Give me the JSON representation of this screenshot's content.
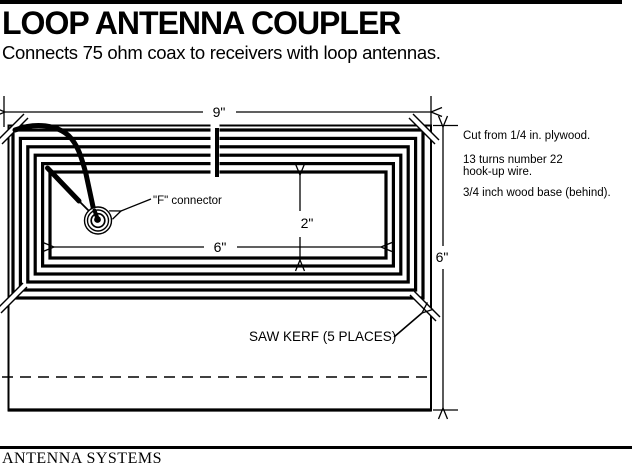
{
  "header": {
    "title": "LOOP ANTENNA COUPLER",
    "subtitle": "Connects 75 ohm coax to receivers with loop antennas."
  },
  "diagram": {
    "dimensions": {
      "overall_width": "9\"",
      "overall_height": "6\"",
      "inner_height": "2\"",
      "inner_width": "6\""
    },
    "labels": {
      "connector": "\"F\" connector",
      "saw_kerf": "SAW KERF (5 PLACES)"
    },
    "notes": {
      "line1": "Cut from 1/4 in. plywood.",
      "line2": "13 turns number 22",
      "line3": "hook-up wire.",
      "line4": "3/4 inch wood base (behind)."
    }
  },
  "footer": {
    "brand": "ANTENNA SYSTEMS"
  },
  "colors": {
    "ink": "#000000",
    "paper": "#ffffff"
  }
}
